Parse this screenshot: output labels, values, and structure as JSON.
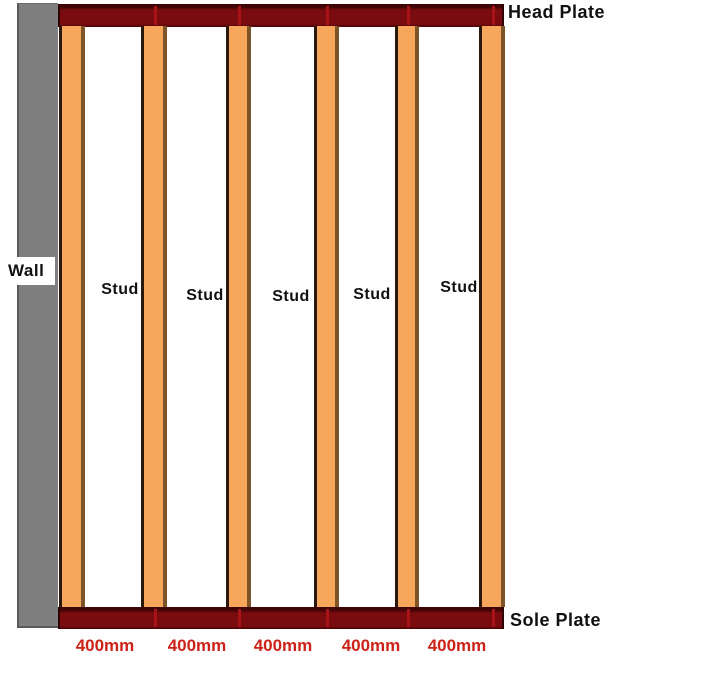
{
  "diagram": {
    "wall_label": "Wall",
    "head_plate_label": "Head Plate",
    "sole_plate_label": "Sole Plate",
    "stud_count": 6
  },
  "bays": [
    {
      "stud_label": "Stud",
      "dimension_label": "400mm"
    },
    {
      "stud_label": "Stud",
      "dimension_label": "400mm"
    },
    {
      "stud_label": "Stud",
      "dimension_label": "400mm"
    },
    {
      "stud_label": "Stud",
      "dimension_label": "400mm"
    },
    {
      "stud_label": "Stud",
      "dimension_label": "400mm"
    }
  ],
  "colors": {
    "background": "#fefefe",
    "plate-body": "#7a0c0f",
    "plate-edge-dark": "#3f0506",
    "plate-seam": "#a81318",
    "stud-fill": "#f7a75c",
    "stud-border-left": "#2a190b",
    "stud-border-right": "#7d5428",
    "wall-gray": "#7f7f80",
    "dimension-red": "#cc2218",
    "label-black": "#111111"
  }
}
